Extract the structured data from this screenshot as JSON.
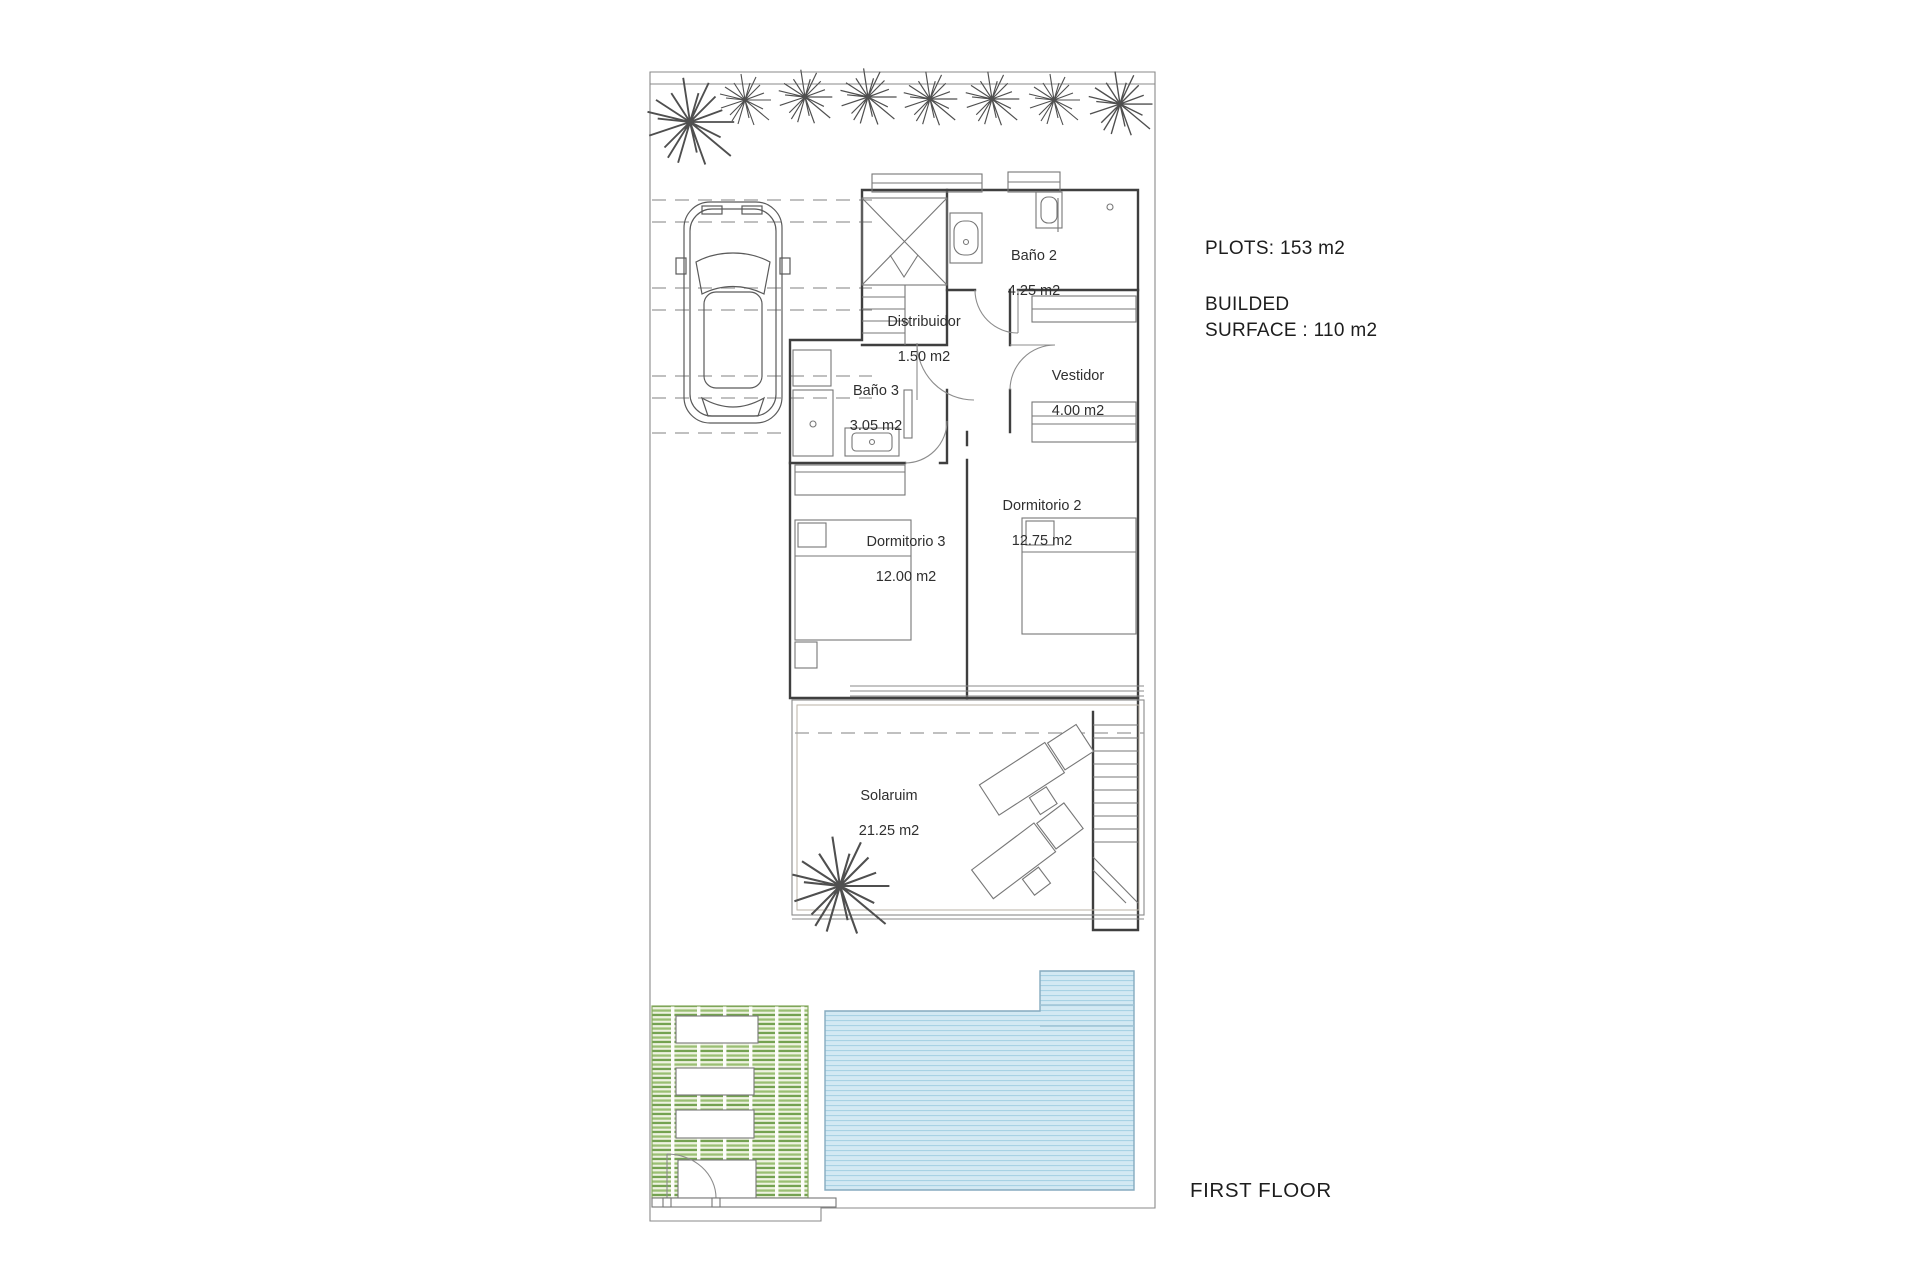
{
  "rooms": [
    {
      "id": "bano2",
      "label": "Baño 2",
      "area": "4.25 m2"
    },
    {
      "id": "distribuidor",
      "label": "Distribuidor",
      "area": "1.50 m2"
    },
    {
      "id": "bano3",
      "label": "Baño 3",
      "area": "3.05 m2"
    },
    {
      "id": "vestidor",
      "label": "Vestidor",
      "area": "4.00 m2"
    },
    {
      "id": "dormitorio2",
      "label": "Dormitorio 2",
      "area": "12.75 m2"
    },
    {
      "id": "dormitorio3",
      "label": "Dormitorio 3",
      "area": "12.00 m2"
    },
    {
      "id": "solarium",
      "label": "Solaruim",
      "area": "21.25 m2"
    }
  ],
  "annotations": {
    "plots": "PLOTS: 153 m2",
    "builded_line1": "BUILDED",
    "builded_line2": "SURFACE : 110 m2",
    "floor_label": "FIRST FLOOR"
  },
  "colors": {
    "wall": "#3f3f3f",
    "line": "#8a8a8a",
    "furniture": "#777777",
    "pool_fill": "#d3e9f3",
    "pool_stripe": "#a8d2e4",
    "pool_border": "#85aabf",
    "wood_fill": "#f1eee8",
    "wood_stripe": "#dcd4c5",
    "green_light": "#eef3e1",
    "green_mid": "#9abf73",
    "green_dark": "#74a251",
    "green_border": "#86a95f",
    "text": "#2f2f2f"
  }
}
